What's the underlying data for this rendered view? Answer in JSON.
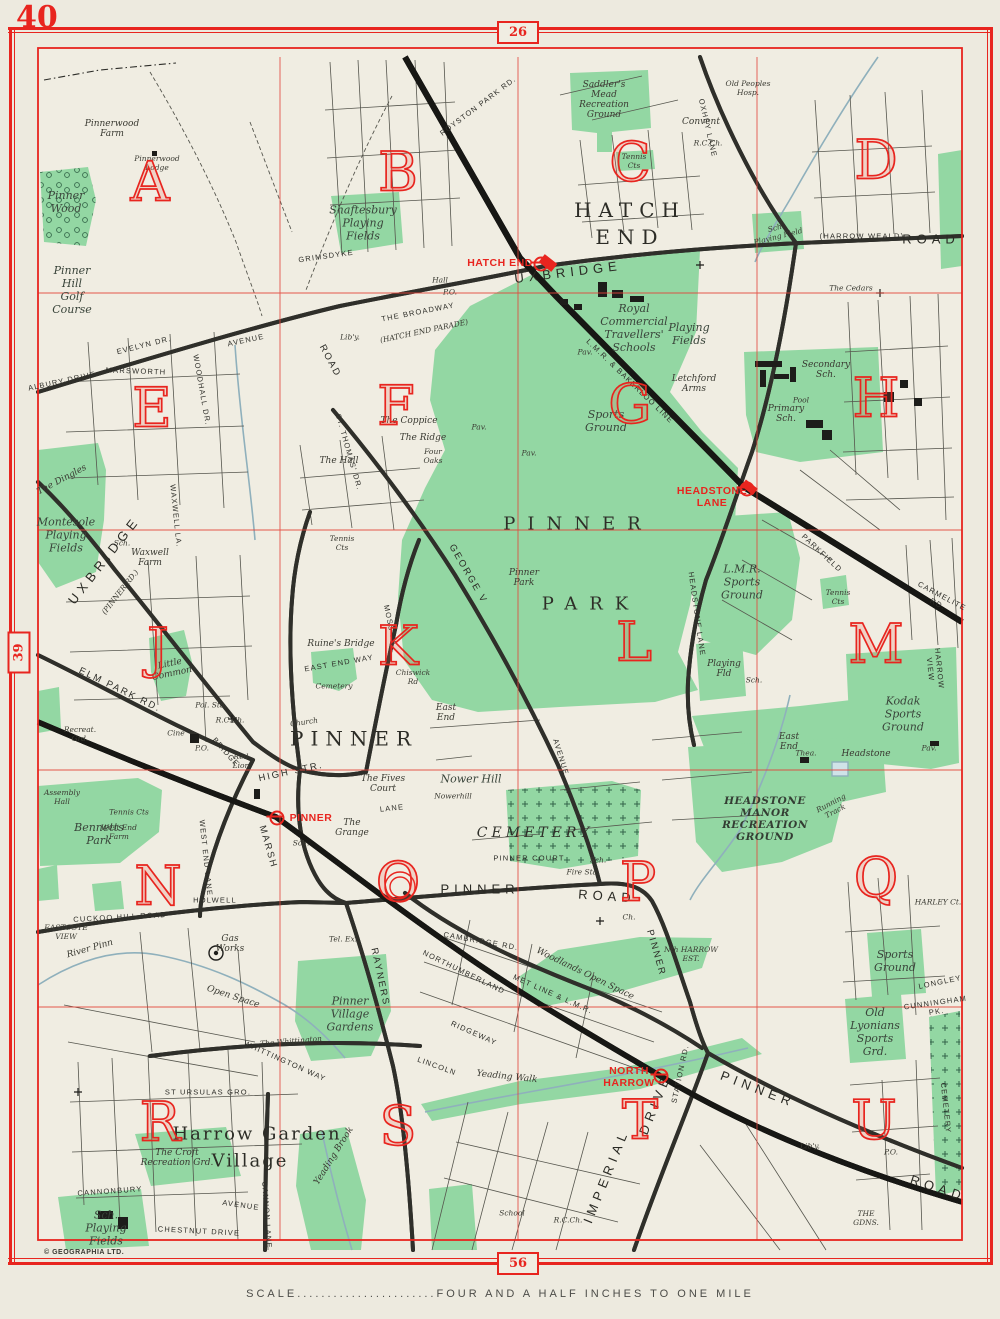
{
  "page": {
    "corner_number": "40",
    "top_tab": "26",
    "left_tab": "39",
    "bottom_tab": "56",
    "scale_label": "SCALE.......................FOUR  AND  A  HALF  INCHES  TO  ONE  MILE",
    "copyright": "© GEOGRAPHIA LTD."
  },
  "colors": {
    "red": "#e8251f",
    "grid_red": "#e2453a",
    "green": "#93d7a3",
    "paper": "#f0ede2",
    "water": "#8fb0bc",
    "road_casing": "#2f2f2a",
    "text": "#2d2d28"
  },
  "grid_letters": [
    {
      "t": "A",
      "x": 150,
      "y": 182
    },
    {
      "t": "B",
      "x": 398,
      "y": 172
    },
    {
      "t": "C",
      "x": 630,
      "y": 162
    },
    {
      "t": "D",
      "x": 876,
      "y": 160
    },
    {
      "t": "E",
      "x": 152,
      "y": 408
    },
    {
      "t": "F",
      "x": 396,
      "y": 406
    },
    {
      "t": "G",
      "x": 630,
      "y": 404
    },
    {
      "t": "H",
      "x": 876,
      "y": 398
    },
    {
      "t": "J",
      "x": 158,
      "y": 648
    },
    {
      "t": "K",
      "x": 398,
      "y": 646
    },
    {
      "t": "L",
      "x": 634,
      "y": 642
    },
    {
      "t": "M",
      "x": 876,
      "y": 644
    },
    {
      "t": "N",
      "x": 158,
      "y": 886
    },
    {
      "t": "O",
      "x": 398,
      "y": 882
    },
    {
      "t": "P",
      "x": 638,
      "y": 882
    },
    {
      "t": "Q",
      "x": 876,
      "y": 878
    },
    {
      "t": "R",
      "x": 160,
      "y": 1122
    },
    {
      "t": "S",
      "x": 398,
      "y": 1126
    },
    {
      "t": "T",
      "x": 640,
      "y": 1120
    },
    {
      "t": "U",
      "x": 874,
      "y": 1120
    }
  ],
  "stations": [
    {
      "label": "HATCH END",
      "lx": 500,
      "ly": 263,
      "sx": 541,
      "sy": 264,
      "icon": "station-circle-icon"
    },
    {
      "label": "HEADSTONE\nLANE",
      "lx": 712,
      "ly": 497,
      "sx": 747,
      "sy": 489,
      "icon": "station-circle-icon"
    },
    {
      "label": "PINNER",
      "lx": 311,
      "ly": 818,
      "sx": 277,
      "sy": 818,
      "icon": "station-circle-icon"
    },
    {
      "label": "NORTH\nHARROW",
      "lx": 629,
      "ly": 1077,
      "sx": 661,
      "sy": 1076,
      "icon": "station-circle-icon"
    }
  ],
  "labels": [
    {
      "t": "Pinnerwood\nFarm",
      "x": 112,
      "y": 129,
      "c": "sm"
    },
    {
      "t": "Pinnerwood\nLodge",
      "x": 157,
      "y": 163,
      "c": "tn"
    },
    {
      "t": "Pinner\nWood",
      "x": 66,
      "y": 202,
      "c": "area"
    },
    {
      "t": "Pinner\nHill\nGolf\nCourse",
      "x": 72,
      "y": 290,
      "c": "area"
    },
    {
      "t": "ALBURY  DRIVE",
      "x": 62,
      "y": 381,
      "c": "rd",
      "r": -12
    },
    {
      "t": "EVELYN  DR.",
      "x": 144,
      "y": 345,
      "c": "rd",
      "r": -14
    },
    {
      "t": "AVENUE",
      "x": 246,
      "y": 340,
      "c": "rd",
      "r": -12
    },
    {
      "t": "MARSWORTH",
      "x": 136,
      "y": 371,
      "c": "rd",
      "r": 2
    },
    {
      "t": "WOODHALL  DR.",
      "x": 202,
      "y": 390,
      "c": "rd",
      "r": 80
    },
    {
      "t": "The Dingles",
      "x": 62,
      "y": 480,
      "c": "sm",
      "r": -28
    },
    {
      "t": "Montesole\nPlaying\nFields",
      "x": 66,
      "y": 535,
      "c": "area"
    },
    {
      "t": "Sch.",
      "x": 122,
      "y": 543,
      "c": "tn"
    },
    {
      "t": "Waxwell\nFarm",
      "x": 150,
      "y": 558,
      "c": "sm"
    },
    {
      "t": "WAXWELL  LA.",
      "x": 176,
      "y": 516,
      "c": "rd",
      "r": 84
    },
    {
      "t": "UXBRIDGE",
      "x": 104,
      "y": 560,
      "c": "rdb",
      "r": -52
    },
    {
      "t": "(PINNER  RD.)",
      "x": 120,
      "y": 592,
      "c": "tn",
      "r": -52
    },
    {
      "t": "GRIMSDYKE",
      "x": 326,
      "y": 256,
      "c": "rd",
      "r": -8
    },
    {
      "t": "Lib'y.",
      "x": 350,
      "y": 337,
      "c": "tn"
    },
    {
      "t": "Hall",
      "x": 440,
      "y": 280,
      "c": "tn"
    },
    {
      "t": "P.O.",
      "x": 450,
      "y": 292,
      "c": "tn"
    },
    {
      "t": "Shaftesbury\nPlaying\nFields",
      "x": 363,
      "y": 223,
      "c": "area"
    },
    {
      "t": "THE  BROADWAY",
      "x": 418,
      "y": 312,
      "c": "rd",
      "r": -11
    },
    {
      "t": "(HATCH  END  PARADE)",
      "x": 424,
      "y": 331,
      "c": "tn",
      "r": -12
    },
    {
      "t": "ROAD",
      "x": 330,
      "y": 361,
      "c": "rdm",
      "r": 62
    },
    {
      "t": "UXBRIDGE",
      "x": 568,
      "y": 272,
      "c": "rdb",
      "r": -7
    },
    {
      "t": "ROYSTON  PARK  RD.",
      "x": 478,
      "y": 106,
      "c": "rd",
      "r": -37
    },
    {
      "t": "HATCH\nEND",
      "x": 630,
      "y": 224,
      "c": "big"
    },
    {
      "t": "Saddler's\nMead\nRecreation\nGround",
      "x": 604,
      "y": 100,
      "c": "sm"
    },
    {
      "t": "Tennis\nCts",
      "x": 634,
      "y": 161,
      "c": "tn"
    },
    {
      "t": "OXHEY  LANE",
      "x": 708,
      "y": 128,
      "c": "rd",
      "r": 77
    },
    {
      "t": "Old Peoples\nHosp.",
      "x": 748,
      "y": 88,
      "c": "tn"
    },
    {
      "t": "Convent",
      "x": 701,
      "y": 122,
      "c": "sm"
    },
    {
      "t": "R.C.Ch.",
      "x": 708,
      "y": 143,
      "c": "tn"
    },
    {
      "t": "(HARROW  WEALD)",
      "x": 862,
      "y": 236,
      "c": "rd"
    },
    {
      "t": "ROAD",
      "x": 931,
      "y": 239,
      "c": "rdb"
    },
    {
      "t": "Sch.\nPlaying Field",
      "x": 777,
      "y": 232,
      "c": "tn",
      "r": -14
    },
    {
      "t": "The Cedars",
      "x": 851,
      "y": 288,
      "c": "tn"
    },
    {
      "t": "Royal\nCommercial\nTravellers'\nSchools",
      "x": 634,
      "y": 328,
      "c": "area"
    },
    {
      "t": "Playing\nFields",
      "x": 689,
      "y": 334,
      "c": "area"
    },
    {
      "t": "Letchford\nArms",
      "x": 694,
      "y": 384,
      "c": "sm"
    },
    {
      "t": "Secondary\nSch.",
      "x": 826,
      "y": 370,
      "c": "sm"
    },
    {
      "t": "Pool",
      "x": 801,
      "y": 400,
      "c": "tn"
    },
    {
      "t": "Primary\nSch.",
      "x": 786,
      "y": 414,
      "c": "sm"
    },
    {
      "t": "Sports\nGround",
      "x": 606,
      "y": 421,
      "c": "area"
    },
    {
      "t": "Pav.",
      "x": 585,
      "y": 352,
      "c": "tn"
    },
    {
      "t": "Pav.",
      "x": 479,
      "y": 427,
      "c": "tn"
    },
    {
      "t": "Pav.",
      "x": 529,
      "y": 453,
      "c": "tn"
    },
    {
      "t": "L.M.R. & BAKERLOO  LINE",
      "x": 630,
      "y": 381,
      "c": "rd",
      "r": 44
    },
    {
      "t": "The Hall",
      "x": 339,
      "y": 461,
      "c": "sm"
    },
    {
      "t": "The Coppice",
      "x": 409,
      "y": 421,
      "c": "sm"
    },
    {
      "t": "The Ridge",
      "x": 423,
      "y": 438,
      "c": "sm"
    },
    {
      "t": "Four\nOaks",
      "x": 433,
      "y": 456,
      "c": "tn"
    },
    {
      "t": "ST.  THOMAS'  DR.",
      "x": 349,
      "y": 452,
      "c": "rd",
      "r": 74
    },
    {
      "t": "Tennis\nCts",
      "x": 342,
      "y": 543,
      "c": "tn"
    },
    {
      "t": "HEADSTONE  LANE",
      "x": 697,
      "y": 614,
      "c": "rd",
      "r": 82
    },
    {
      "t": "PINNER",
      "x": 578,
      "y": 524,
      "c": "park"
    },
    {
      "t": "PARK",
      "x": 591,
      "y": 604,
      "c": "park"
    },
    {
      "t": "Pinner\nPark",
      "x": 524,
      "y": 578,
      "c": "sm"
    },
    {
      "t": "GEORGE  V",
      "x": 468,
      "y": 574,
      "c": "rdm",
      "r": 60
    },
    {
      "t": "AVENUE",
      "x": 561,
      "y": 757,
      "c": "rd",
      "r": 73
    },
    {
      "t": "East\nEnd",
      "x": 446,
      "y": 713,
      "c": "sm"
    },
    {
      "t": "Chiswick\nRd",
      "x": 413,
      "y": 677,
      "c": "tn"
    },
    {
      "t": "MOSS  LA.",
      "x": 391,
      "y": 627,
      "c": "rd",
      "r": 78
    },
    {
      "t": "Ruine's Bridge",
      "x": 341,
      "y": 644,
      "c": "sm"
    },
    {
      "t": "EAST  END  WAY",
      "x": 339,
      "y": 663,
      "c": "rd",
      "r": -10
    },
    {
      "t": "Cemetery",
      "x": 334,
      "y": 686,
      "c": "tn"
    },
    {
      "t": "Little\nCommon",
      "x": 171,
      "y": 669,
      "c": "sm",
      "r": -12
    },
    {
      "t": "ELM  PARK  RD.",
      "x": 120,
      "y": 690,
      "c": "rdm",
      "r": 26
    },
    {
      "t": "Recreat.\nGrd.",
      "x": 80,
      "y": 734,
      "c": "tn"
    },
    {
      "t": "Pol. Sta.",
      "x": 211,
      "y": 705,
      "c": "tn"
    },
    {
      "t": "R.C.Ch.",
      "x": 230,
      "y": 720,
      "c": "tn"
    },
    {
      "t": "Cine",
      "x": 176,
      "y": 733,
      "c": "tn"
    },
    {
      "t": "P.O.",
      "x": 202,
      "y": 748,
      "c": "tn"
    },
    {
      "t": "BRIDGE",
      "x": 226,
      "y": 752,
      "c": "rd",
      "r": 48
    },
    {
      "t": "PINNER",
      "x": 354,
      "y": 739,
      "c": "big"
    },
    {
      "t": "Red\nLion",
      "x": 241,
      "y": 761,
      "c": "tn"
    },
    {
      "t": "Church",
      "x": 304,
      "y": 722,
      "c": "tn",
      "r": -8
    },
    {
      "t": "HIGH  STR.",
      "x": 291,
      "y": 772,
      "c": "rdm",
      "r": -12
    },
    {
      "t": "MARSH",
      "x": 268,
      "y": 847,
      "c": "rdm",
      "r": 74
    },
    {
      "t": "Assembly\nHall",
      "x": 62,
      "y": 797,
      "c": "tn"
    },
    {
      "t": "Bennetts\nPark",
      "x": 99,
      "y": 834,
      "c": "area"
    },
    {
      "t": "Tennis Cts",
      "x": 129,
      "y": 812,
      "c": "tn"
    },
    {
      "t": "West End\nFarm",
      "x": 119,
      "y": 832,
      "c": "tn"
    },
    {
      "t": "Sch.",
      "x": 301,
      "y": 843,
      "c": "tn"
    },
    {
      "t": "The\nGrange",
      "x": 352,
      "y": 828,
      "c": "sm"
    },
    {
      "t": "The Fives\nCourt",
      "x": 383,
      "y": 784,
      "c": "sm"
    },
    {
      "t": "Nower Hill",
      "x": 471,
      "y": 779,
      "c": "area"
    },
    {
      "t": "Nowerhill",
      "x": 453,
      "y": 796,
      "c": "tn"
    },
    {
      "t": "LANE",
      "x": 392,
      "y": 808,
      "c": "rd",
      "r": -6
    },
    {
      "t": "East\nEnd",
      "x": 789,
      "y": 742,
      "c": "sm"
    },
    {
      "t": "WEST  END  LANE",
      "x": 206,
      "y": 858,
      "c": "rd",
      "r": 84
    },
    {
      "t": "HOLWELL",
      "x": 215,
      "y": 900,
      "c": "rd"
    },
    {
      "t": "CUCKOO  HILL  ROAD",
      "x": 120,
      "y": 917,
      "c": "rd",
      "r": -3
    },
    {
      "t": "EASTCOTE\nVIEW",
      "x": 66,
      "y": 932,
      "c": "tn"
    },
    {
      "t": "River  Pinn",
      "x": 90,
      "y": 949,
      "c": "sm",
      "r": -16
    },
    {
      "t": "Gas\nWorks",
      "x": 230,
      "y": 944,
      "c": "sm"
    },
    {
      "t": "Open Space",
      "x": 233,
      "y": 997,
      "c": "sm",
      "r": 18
    },
    {
      "t": "CEMETERY",
      "x": 535,
      "y": 833,
      "c": "cem"
    },
    {
      "t": "PINNER  COURT",
      "x": 529,
      "y": 858,
      "c": "rd"
    },
    {
      "t": "Sch.",
      "x": 598,
      "y": 860,
      "c": "tn"
    },
    {
      "t": "Fire Sta.",
      "x": 583,
      "y": 872,
      "c": "tn"
    },
    {
      "t": "PINNER",
      "x": 480,
      "y": 889,
      "c": "rdb"
    },
    {
      "t": "ROAD",
      "x": 607,
      "y": 896,
      "c": "rdb",
      "r": 4
    },
    {
      "t": "Ch.",
      "x": 629,
      "y": 917,
      "c": "tn"
    },
    {
      "t": "PINNER",
      "x": 656,
      "y": 953,
      "c": "rdm",
      "r": 74
    },
    {
      "t": "Nth  HARROW\nEST.",
      "x": 691,
      "y": 954,
      "c": "tn"
    },
    {
      "t": "Woodlands  Open  Space",
      "x": 585,
      "y": 974,
      "c": "sm",
      "r": 26
    },
    {
      "t": "CAMBRIDGE  RD.",
      "x": 481,
      "y": 941,
      "c": "rd",
      "r": 10
    },
    {
      "t": "MET  LINE  &  L.M.R.",
      "x": 553,
      "y": 994,
      "c": "rd",
      "r": 24
    },
    {
      "t": "NORTHUMBERLAND",
      "x": 464,
      "y": 972,
      "c": "rd",
      "r": 26
    },
    {
      "t": "RIDGEWAY",
      "x": 474,
      "y": 1033,
      "c": "rd",
      "r": 24
    },
    {
      "t": "LINCOLN",
      "x": 437,
      "y": 1066,
      "c": "rd",
      "r": 20
    },
    {
      "t": "RAYNERS",
      "x": 380,
      "y": 977,
      "c": "rdm",
      "r": 78
    },
    {
      "t": "Tel. Ex.",
      "x": 343,
      "y": 939,
      "c": "tn"
    },
    {
      "t": "Pinner\nVillage\nGardens",
      "x": 350,
      "y": 1014,
      "c": "area"
    },
    {
      "t": "L.M.R.\nSports\nGround",
      "x": 742,
      "y": 582,
      "c": "area"
    },
    {
      "t": "Tennis\nCts",
      "x": 838,
      "y": 597,
      "c": "tn"
    },
    {
      "t": "PARKFIELD",
      "x": 822,
      "y": 553,
      "c": "rd",
      "r": 43
    },
    {
      "t": "CARMELITE  RD.",
      "x": 940,
      "y": 600,
      "c": "rd",
      "r": 28
    },
    {
      "t": "HARROW  VIEW",
      "x": 935,
      "y": 669,
      "c": "rd",
      "r": 84
    },
    {
      "t": "Playing\nFld",
      "x": 724,
      "y": 669,
      "c": "sm"
    },
    {
      "t": "Sch.",
      "x": 754,
      "y": 680,
      "c": "tn"
    },
    {
      "t": "Kodak\nSports\nGround",
      "x": 903,
      "y": 714,
      "c": "area"
    },
    {
      "t": "Pav.",
      "x": 929,
      "y": 748,
      "c": "tn"
    },
    {
      "t": "Thea.",
      "x": 806,
      "y": 753,
      "c": "tn"
    },
    {
      "t": "Headstone",
      "x": 866,
      "y": 754,
      "c": "sm"
    },
    {
      "t": "Running\nTrack",
      "x": 833,
      "y": 807,
      "c": "tn",
      "r": -28
    },
    {
      "t": "HEADSTONE\nMANOR\nRECREATION\nGROUND",
      "x": 765,
      "y": 819,
      "c": "areab"
    },
    {
      "t": "Sports\nGround",
      "x": 895,
      "y": 961,
      "c": "area"
    },
    {
      "t": "HARLEY  Ct.",
      "x": 938,
      "y": 902,
      "c": "tn"
    },
    {
      "t": "LONGLEY",
      "x": 940,
      "y": 982,
      "c": "rd",
      "r": -12
    },
    {
      "t": "CUNNINGHAM  PK.",
      "x": 936,
      "y": 1007,
      "c": "rd",
      "r": -8
    },
    {
      "t": "Old\nLyonians\nSports\nGrd.",
      "x": 875,
      "y": 1032,
      "c": "area"
    },
    {
      "t": "CEMETERY",
      "x": 946,
      "y": 1108,
      "c": "rd",
      "r": 84
    },
    {
      "t": "Lib'y.",
      "x": 810,
      "y": 1146,
      "c": "tn"
    },
    {
      "t": "P.O.",
      "x": 891,
      "y": 1152,
      "c": "tn"
    },
    {
      "t": "THE\nGDNS.",
      "x": 866,
      "y": 1218,
      "c": "tn"
    },
    {
      "t": "PINNER",
      "x": 758,
      "y": 1089,
      "c": "rdb",
      "r": 21
    },
    {
      "t": "ROAD",
      "x": 938,
      "y": 1188,
      "c": "rdb",
      "r": 18
    },
    {
      "t": "STATION  RD.",
      "x": 680,
      "y": 1074,
      "c": "rd",
      "r": -78
    },
    {
      "t": "IMPERIAL",
      "x": 606,
      "y": 1176,
      "c": "rdb",
      "r": -68
    },
    {
      "t": "DRIVE",
      "x": 655,
      "y": 1104,
      "c": "rdb",
      "r": -68
    },
    {
      "t": "Yeading  Walk",
      "x": 507,
      "y": 1077,
      "c": "sm",
      "r": 6
    },
    {
      "t": "School",
      "x": 512,
      "y": 1213,
      "c": "tn"
    },
    {
      "t": "R.C.Ch.",
      "x": 568,
      "y": 1220,
      "c": "tn"
    },
    {
      "t": "Harrow  Garden",
      "x": 257,
      "y": 1134,
      "c": "vill"
    },
    {
      "t": "Village",
      "x": 250,
      "y": 1161,
      "c": "vill"
    },
    {
      "t": "The Croft\nRecreation Grd.",
      "x": 177,
      "y": 1158,
      "c": "sm"
    },
    {
      "t": "CANNONBURY",
      "x": 110,
      "y": 1191,
      "c": "rd",
      "r": -4
    },
    {
      "t": "AVENUE",
      "x": 241,
      "y": 1205,
      "c": "rd",
      "r": 8
    },
    {
      "t": "CHESTNUT  DRIVE",
      "x": 199,
      "y": 1231,
      "c": "rd",
      "r": 3
    },
    {
      "t": "ST  URSULAS  GRO.",
      "x": 208,
      "y": 1092,
      "c": "rd"
    },
    {
      "t": "The Whittington",
      "x": 291,
      "y": 1041,
      "c": "tn",
      "r": -5
    },
    {
      "t": "WHITTINGTON  WAY",
      "x": 285,
      "y": 1061,
      "c": "rd",
      "r": 24
    },
    {
      "t": "CANNON  LANE",
      "x": 267,
      "y": 1215,
      "c": "rd",
      "r": 86
    },
    {
      "t": "Sch.\nPlaying\nFields",
      "x": 106,
      "y": 1228,
      "c": "area"
    },
    {
      "t": "Yeading  Brook",
      "x": 334,
      "y": 1156,
      "c": "sm",
      "r": -58
    }
  ]
}
